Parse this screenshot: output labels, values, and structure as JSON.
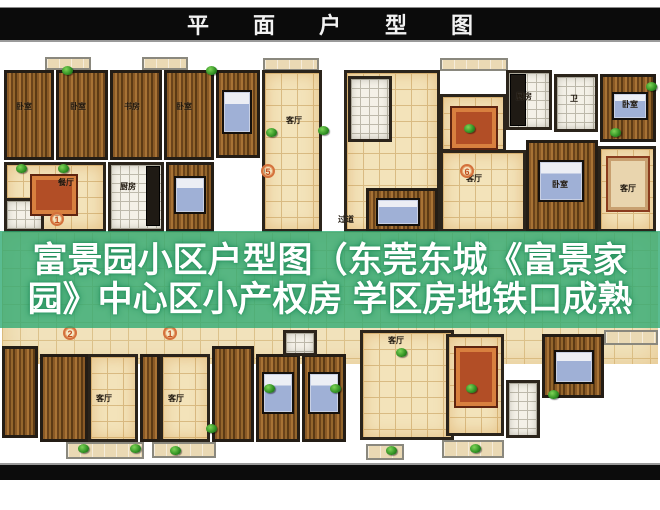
{
  "banner": {
    "title": "平面户型图"
  },
  "overlay": {
    "line1": "富景园小区户型图（东莞东城《富景家",
    "line2": "园》中心区小产权房 学区房地铁口成熟",
    "bg_color": "#2ca972",
    "text_color": "#ffffff"
  },
  "palette": {
    "banner_bg": "#0b0b0b",
    "wall": "#2b241b",
    "wood_floor": "#8a5a26",
    "tan_tile": "#f3e3ba",
    "white_tile": "#f4f1e8",
    "plant_green": "#2f8f22",
    "marker_orange": "#d4713c"
  },
  "floorplan": {
    "room_label_names": [
      "卧室",
      "书房",
      "餐厅",
      "厨房",
      "客厅",
      "卫",
      "过道"
    ],
    "unit_markers": [
      "5",
      "6",
      "1",
      "2",
      "1"
    ],
    "items": [
      {
        "t": "corridor",
        "x": 2,
        "y": 178,
        "w": 656,
        "h": 132
      },
      {
        "t": "balcony",
        "x": 45,
        "y": 3,
        "w": 46,
        "h": 13
      },
      {
        "t": "balcony",
        "x": 142,
        "y": 3,
        "w": 46,
        "h": 13
      },
      {
        "t": "balcony",
        "x": 263,
        "y": 4,
        "w": 56,
        "h": 13
      },
      {
        "t": "balcony",
        "x": 440,
        "y": 4,
        "w": 68,
        "h": 13
      },
      {
        "t": "wood",
        "x": 4,
        "y": 16,
        "w": 50,
        "h": 90
      },
      {
        "t": "wood",
        "x": 56,
        "y": 16,
        "w": 52,
        "h": 90
      },
      {
        "t": "wood",
        "x": 110,
        "y": 16,
        "w": 52,
        "h": 90
      },
      {
        "t": "wood",
        "x": 164,
        "y": 16,
        "w": 50,
        "h": 90
      },
      {
        "t": "tile",
        "x": 4,
        "y": 108,
        "w": 102,
        "h": 70
      },
      {
        "t": "white",
        "x": 108,
        "y": 108,
        "w": 56,
        "h": 70
      },
      {
        "t": "white",
        "x": 4,
        "y": 144,
        "w": 40,
        "h": 34
      },
      {
        "t": "wood",
        "x": 166,
        "y": 108,
        "w": 48,
        "h": 70
      },
      {
        "t": "wood",
        "x": 216,
        "y": 16,
        "w": 44,
        "h": 88
      },
      {
        "t": "tile",
        "x": 262,
        "y": 16,
        "w": 60,
        "h": 162
      },
      {
        "t": "tile",
        "x": 344,
        "y": 16,
        "w": 96,
        "h": 162
      },
      {
        "t": "white",
        "x": 348,
        "y": 22,
        "w": 44,
        "h": 66
      },
      {
        "t": "wood",
        "x": 366,
        "y": 134,
        "w": 72,
        "h": 44
      },
      {
        "t": "tile",
        "x": 440,
        "y": 40,
        "w": 66,
        "h": 58
      },
      {
        "t": "white",
        "x": 506,
        "y": 16,
        "w": 46,
        "h": 60
      },
      {
        "t": "white",
        "x": 554,
        "y": 20,
        "w": 44,
        "h": 58
      },
      {
        "t": "wood",
        "x": 600,
        "y": 20,
        "w": 56,
        "h": 68
      },
      {
        "t": "tile",
        "x": 440,
        "y": 96,
        "w": 86,
        "h": 82
      },
      {
        "t": "wood",
        "x": 526,
        "y": 86,
        "w": 72,
        "h": 92
      },
      {
        "t": "tile",
        "x": 598,
        "y": 92,
        "w": 58,
        "h": 86
      },
      {
        "t": "wood",
        "x": 2,
        "y": 292,
        "w": 36,
        "h": 92
      },
      {
        "t": "wood",
        "x": 40,
        "y": 300,
        "w": 48,
        "h": 88
      },
      {
        "t": "tile",
        "x": 88,
        "y": 300,
        "w": 50,
        "h": 88
      },
      {
        "t": "wood",
        "x": 140,
        "y": 300,
        "w": 20,
        "h": 88
      },
      {
        "t": "tile",
        "x": 160,
        "y": 300,
        "w": 50,
        "h": 88
      },
      {
        "t": "wood",
        "x": 212,
        "y": 292,
        "w": 42,
        "h": 96
      },
      {
        "t": "wood",
        "x": 256,
        "y": 300,
        "w": 44,
        "h": 88
      },
      {
        "t": "wood",
        "x": 302,
        "y": 300,
        "w": 44,
        "h": 88
      },
      {
        "t": "white",
        "x": 283,
        "y": 276,
        "w": 34,
        "h": 26
      },
      {
        "t": "tile",
        "x": 360,
        "y": 276,
        "w": 94,
        "h": 110
      },
      {
        "t": "tile",
        "x": 446,
        "y": 280,
        "w": 58,
        "h": 102
      },
      {
        "t": "white",
        "x": 506,
        "y": 326,
        "w": 34,
        "h": 58
      },
      {
        "t": "wood",
        "x": 542,
        "y": 280,
        "w": 62,
        "h": 64
      },
      {
        "t": "counter",
        "x": 146,
        "y": 112,
        "w": 14,
        "h": 60
      },
      {
        "t": "counter",
        "x": 510,
        "y": 20,
        "w": 16,
        "h": 52
      },
      {
        "t": "bed",
        "x": 174,
        "y": 122,
        "w": 32,
        "h": 38
      },
      {
        "t": "bed",
        "x": 222,
        "y": 36,
        "w": 30,
        "h": 44
      },
      {
        "t": "bed",
        "x": 612,
        "y": 38,
        "w": 36,
        "h": 28
      },
      {
        "t": "bed",
        "x": 538,
        "y": 106,
        "w": 46,
        "h": 42
      },
      {
        "t": "bed",
        "x": 376,
        "y": 144,
        "w": 44,
        "h": 28
      },
      {
        "t": "bed",
        "x": 262,
        "y": 318,
        "w": 32,
        "h": 42
      },
      {
        "t": "bed",
        "x": 308,
        "y": 318,
        "w": 32,
        "h": 42
      },
      {
        "t": "bed",
        "x": 554,
        "y": 296,
        "w": 40,
        "h": 34
      },
      {
        "t": "table",
        "x": 30,
        "y": 120,
        "w": 48,
        "h": 42
      },
      {
        "t": "table",
        "x": 450,
        "y": 52,
        "w": 48,
        "h": 44
      },
      {
        "t": "table",
        "x": 454,
        "y": 292,
        "w": 44,
        "h": 62
      },
      {
        "t": "sofa",
        "x": 606,
        "y": 102,
        "w": 44,
        "h": 56
      },
      {
        "t": "balcony",
        "x": 66,
        "y": 388,
        "w": 78,
        "h": 17
      },
      {
        "t": "balcony",
        "x": 152,
        "y": 388,
        "w": 64,
        "h": 16
      },
      {
        "t": "balcony",
        "x": 366,
        "y": 390,
        "w": 38,
        "h": 16
      },
      {
        "t": "balcony",
        "x": 442,
        "y": 386,
        "w": 62,
        "h": 18
      },
      {
        "t": "balcony",
        "x": 604,
        "y": 276,
        "w": 54,
        "h": 15
      },
      {
        "t": "plant",
        "x": 62,
        "y": 12
      },
      {
        "t": "plant",
        "x": 206,
        "y": 12
      },
      {
        "t": "plant",
        "x": 266,
        "y": 74
      },
      {
        "t": "plant",
        "x": 16,
        "y": 110
      },
      {
        "t": "plant",
        "x": 58,
        "y": 110
      },
      {
        "t": "plant",
        "x": 318,
        "y": 72
      },
      {
        "t": "plant",
        "x": 464,
        "y": 70
      },
      {
        "t": "plant",
        "x": 610,
        "y": 74
      },
      {
        "t": "plant",
        "x": 646,
        "y": 28
      },
      {
        "t": "plant",
        "x": 396,
        "y": 294
      },
      {
        "t": "plant",
        "x": 206,
        "y": 370
      },
      {
        "t": "plant",
        "x": 264,
        "y": 330
      },
      {
        "t": "plant",
        "x": 330,
        "y": 330
      },
      {
        "t": "plant",
        "x": 466,
        "y": 330
      },
      {
        "t": "plant",
        "x": 78,
        "y": 390
      },
      {
        "t": "plant",
        "x": 130,
        "y": 390
      },
      {
        "t": "plant",
        "x": 170,
        "y": 392
      },
      {
        "t": "plant",
        "x": 386,
        "y": 392
      },
      {
        "t": "plant",
        "x": 470,
        "y": 390
      },
      {
        "t": "plant",
        "x": 548,
        "y": 336
      },
      {
        "t": "label",
        "x": 16,
        "y": 48,
        "text": "卧室"
      },
      {
        "t": "label",
        "x": 70,
        "y": 48,
        "text": "卧室"
      },
      {
        "t": "label",
        "x": 124,
        "y": 48,
        "text": "书房"
      },
      {
        "t": "label",
        "x": 176,
        "y": 48,
        "text": "卧室"
      },
      {
        "t": "label",
        "x": 58,
        "y": 124,
        "text": "餐厅"
      },
      {
        "t": "label",
        "x": 120,
        "y": 128,
        "text": "厨房"
      },
      {
        "t": "label",
        "x": 286,
        "y": 62,
        "text": "客厅"
      },
      {
        "t": "label",
        "x": 338,
        "y": 161,
        "text": "过道"
      },
      {
        "t": "label",
        "x": 516,
        "y": 38,
        "text": "厨房"
      },
      {
        "t": "label",
        "x": 570,
        "y": 40,
        "text": "卫"
      },
      {
        "t": "label",
        "x": 622,
        "y": 46,
        "text": "卧室"
      },
      {
        "t": "label",
        "x": 466,
        "y": 120,
        "text": "客厅"
      },
      {
        "t": "label",
        "x": 552,
        "y": 126,
        "text": "卧室"
      },
      {
        "t": "label",
        "x": 620,
        "y": 130,
        "text": "客厅"
      },
      {
        "t": "label",
        "x": 96,
        "y": 340,
        "text": "客厅"
      },
      {
        "t": "label",
        "x": 168,
        "y": 340,
        "text": "客厅"
      },
      {
        "t": "label",
        "x": 388,
        "y": 282,
        "text": "客厅"
      },
      {
        "t": "marker",
        "x": 261,
        "y": 110,
        "n": "5"
      },
      {
        "t": "marker",
        "x": 460,
        "y": 110,
        "n": "6"
      },
      {
        "t": "marker",
        "x": 50,
        "y": 158,
        "n": "1"
      },
      {
        "t": "marker",
        "x": 63,
        "y": 272,
        "n": "2"
      },
      {
        "t": "marker",
        "x": 163,
        "y": 272,
        "n": "1"
      }
    ]
  }
}
